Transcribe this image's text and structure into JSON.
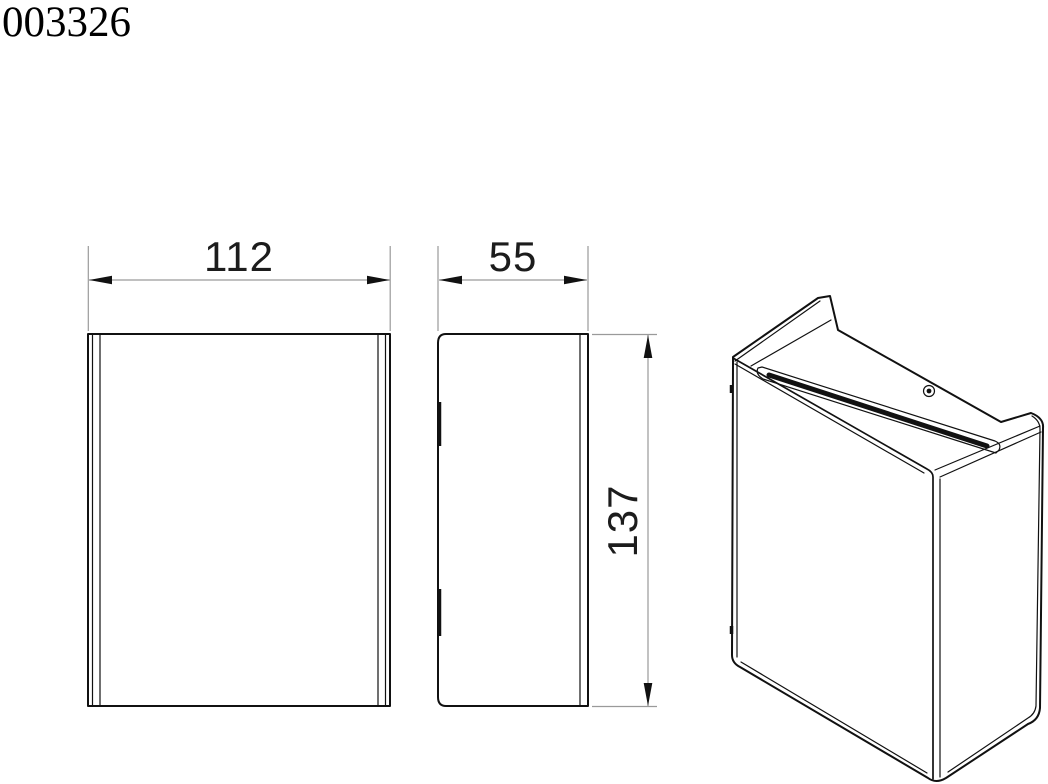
{
  "title": "003326",
  "dimensions": {
    "width": "112",
    "depth": "55",
    "height": "137"
  },
  "colors": {
    "line": "#111111",
    "dimension_line": "#9a9a9a",
    "text": "#1c1c1c"
  }
}
